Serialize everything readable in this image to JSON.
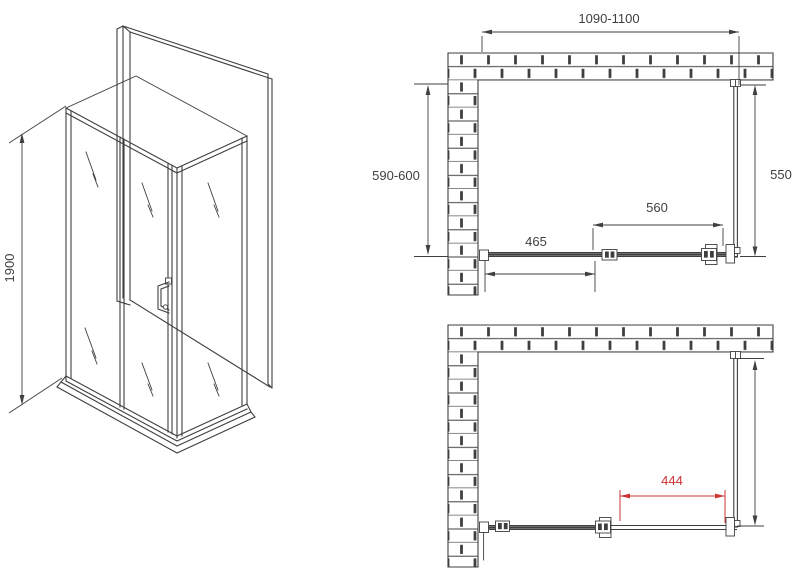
{
  "colors": {
    "line": "#3f3f3f",
    "accent_red": "#cc3333",
    "background": "#ffffff"
  },
  "iso_view": {
    "height_dim": "1900"
  },
  "plan_top_view": {
    "width_dim": "1090-1100",
    "depth_dim": "590-600",
    "side_panel_dim": "550",
    "door_dim": "560",
    "fixed_panel_dim": "465"
  },
  "plan_bottom_view": {
    "opening_dim": "444"
  }
}
